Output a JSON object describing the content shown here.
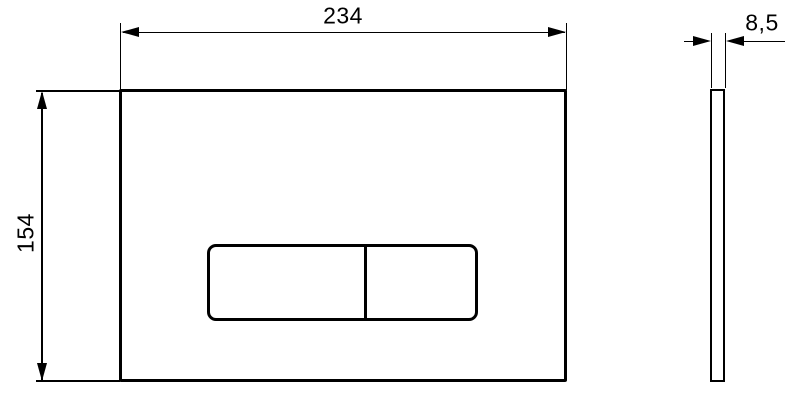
{
  "colors": {
    "background": "#ffffff",
    "line": "#000000"
  },
  "drawing": {
    "type": "technical-dimension-drawing",
    "subject": "rectangular flush plate with dual buttons, front and side views"
  },
  "dimensions": {
    "plate_width": "234",
    "plate_height": "154",
    "plate_thickness": "8,5"
  }
}
